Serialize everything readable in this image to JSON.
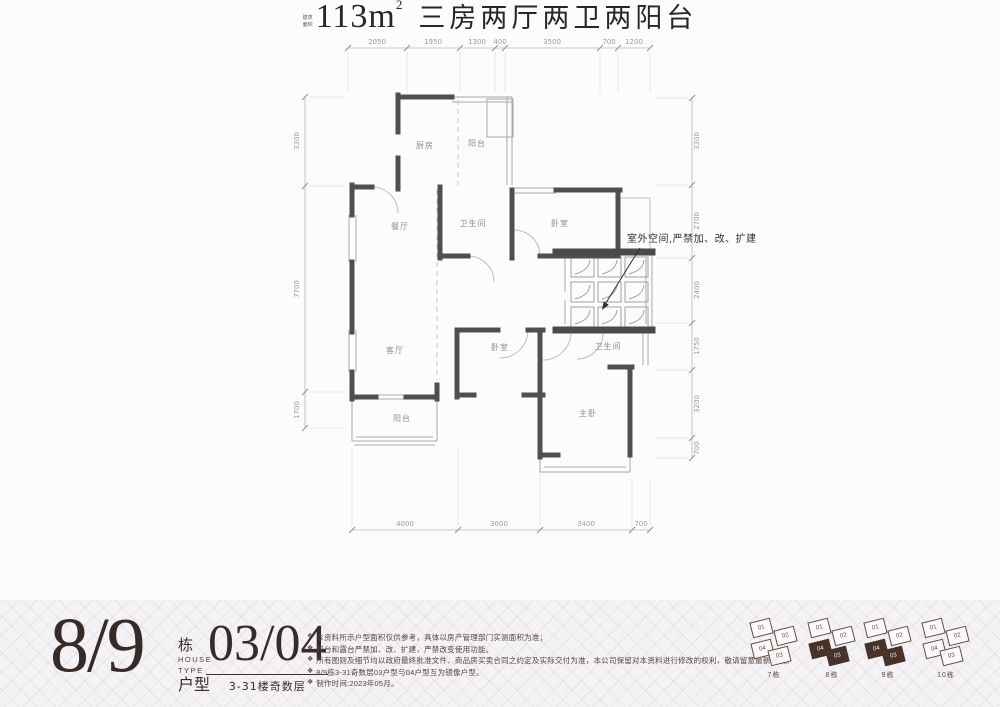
{
  "plan": {
    "rooms": [
      "厨房",
      "阳台",
      "餐厅",
      "卫生间",
      "卧室",
      "客厅",
      "卧室",
      "卫生间",
      "主卧",
      "阳台"
    ],
    "annotation": "室外空间,严禁加、改、扩建",
    "dims": {
      "top": [
        "2050",
        "1950",
        "1300",
        "400",
        "3500",
        "700",
        "1200"
      ],
      "left": [
        "3300",
        "7700",
        "1700"
      ],
      "right": [
        "3300",
        "2700",
        "2400",
        "1750",
        "3200",
        "700"
      ],
      "bottom": [
        "4000",
        "3000",
        "3400",
        "700"
      ]
    }
  },
  "title": {
    "area_prefix": "建筑面积",
    "area_value": "113m",
    "area_sup": "2",
    "desc": "三房两厅两卫两阳台"
  },
  "footer": {
    "block_number": "8/9",
    "block_suffix": {
      "dong": "栋",
      "house": "HOUSE",
      "type": "TYPE",
      "huxing": "户型"
    },
    "unit_number": "03/04",
    "floors_label": "3-31楼奇数层",
    "note_bullet": "❖",
    "notes": [
      "本资料所示户型面积仅供参考，具体以房产管理部门实测面积为准；",
      "阳台和露台严禁加、改、扩建，严禁改变使用功能。",
      "所有图则及细节均以政府最终批准文件、商品房买卖合同之约定及实际交付为准，本公司保留对本资料进行修改的权利，敬请留意最新资讯。",
      "8/9栋3-31奇数层03户型与04户型互为镜像户型。",
      "制作时间:2023年05月。"
    ],
    "unit_cells": [
      "01",
      "02",
      "03",
      "04"
    ],
    "buildings": [
      {
        "label": "7栋",
        "highlight": false
      },
      {
        "label": "8栋",
        "highlight": true
      },
      {
        "label": "9栋",
        "highlight": true
      },
      {
        "label": "10栋",
        "highlight": false
      }
    ]
  },
  "colors": {
    "wall": "#4f4f4f",
    "accent_dark": "#372b28",
    "pattern_bg": "#f4f2f5"
  }
}
